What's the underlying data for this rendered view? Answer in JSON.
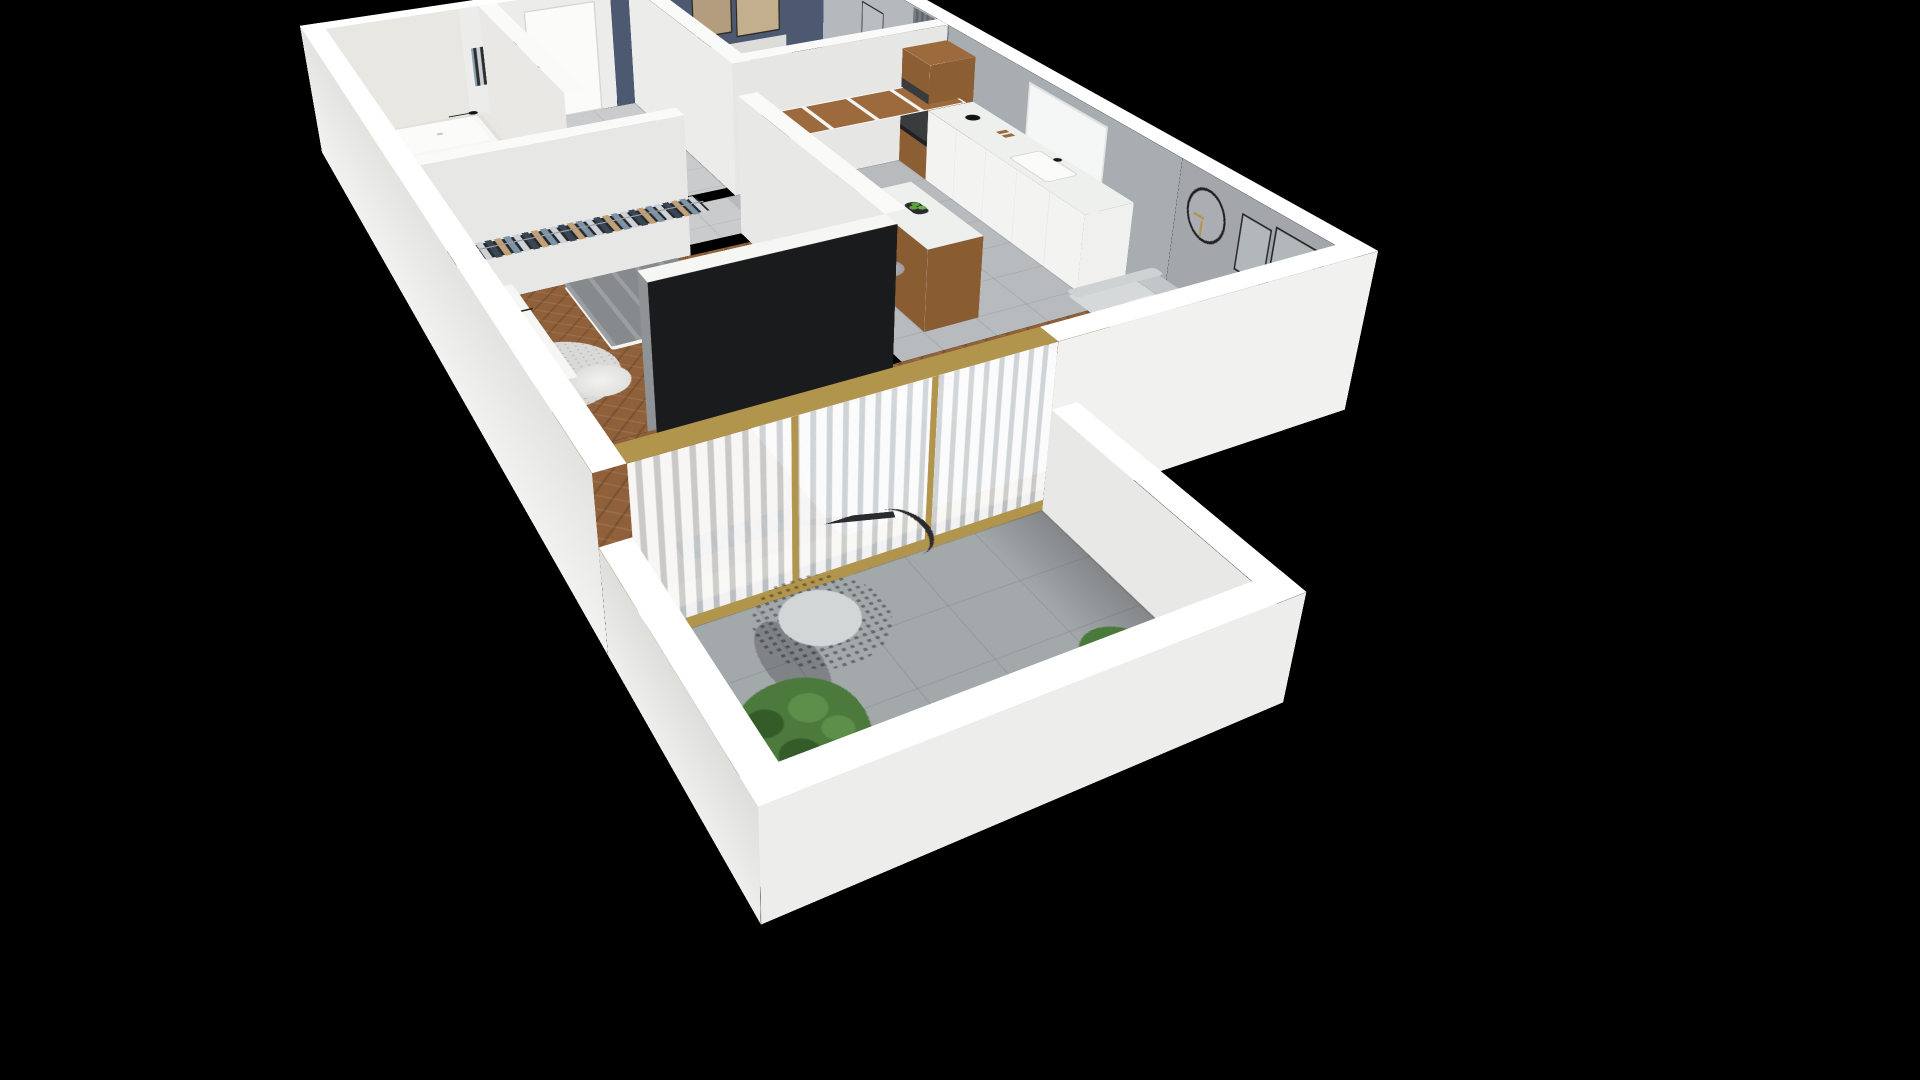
{
  "scene": {
    "type": "3d-isometric-floorplan-render",
    "background": "#000000",
    "apartment": {
      "rooms": [
        {
          "name": "bedroom-1",
          "floor": "wood-herringbone",
          "items": [
            "navy-accent-wall",
            "double-bed",
            "white-pillows",
            "gray-throw-blanket",
            "framed-artwork-pair",
            "side-wall-picture",
            "dark-curtain",
            "open-wood-wardrobe",
            "small-plant"
          ]
        },
        {
          "name": "entry-hall",
          "floor": "gray-tile",
          "items": [
            "entrance-door",
            "black-door-handle",
            "wall-coat-rack-with-hangers"
          ]
        },
        {
          "name": "bathroom",
          "floor": "gray-tile",
          "items": [
            "marble-surround",
            "bathtub",
            "black-shower-mixer"
          ]
        },
        {
          "name": "corridor",
          "floor": "gray-tile",
          "items": [
            "open-white-door"
          ]
        },
        {
          "name": "bedroom-2",
          "floor": "wood-herringbone",
          "items": [
            "bed",
            "gray-blanket",
            "open-clothes-rack",
            "hangers-with-clothes",
            "desk",
            "black-desk-lamp",
            "open-book",
            "fluffy-chair",
            "round-fluffy-rug"
          ]
        },
        {
          "name": "kitchen",
          "floor": "gray-tile",
          "items": [
            "window",
            "tall-wood-cabinet",
            "oven",
            "marble-countertop",
            "sink",
            "black-faucet",
            "kettle",
            "spice-jars",
            "kitchen-island",
            "bar-stools",
            "plate-of-green-apples"
          ]
        },
        {
          "name": "living-room",
          "floor": "wood-herringbone",
          "items": [
            "wall-clock",
            "gallery-of-five-frames",
            "sofa",
            "striped-cushion",
            "area-rug",
            "round-coffee-table",
            "flower-vase",
            "floor-lamp",
            "radiator",
            "gold-framed-glazing",
            "sheer-curtains",
            "gold-threshold"
          ]
        },
        {
          "name": "balcony",
          "floor": "large-gray-tiles",
          "items": [
            "white-parapet",
            "hanging-egg-chair",
            "chair-stand",
            "large-potted-plant",
            "small-potted-plant",
            "plant-stands"
          ]
        }
      ]
    },
    "colors": {
      "background": "#000000",
      "wall_top": "#ffffff",
      "wall_outer": "#f1f1ef",
      "wall_inner_white": "#ececea",
      "navy_accent_wall": "#4d5970",
      "gray_wall": "#a8adb1",
      "gray_wall_light": "#b5b9bd",
      "wood_floor": "#8f6039",
      "wood_cabinet": "#9c6a3c",
      "tile_floor": "#c9cbcc",
      "kitchen_tile": "#b8bbbd",
      "balcony_tile": "#a3a8aa",
      "marble": "#eef0ed",
      "sofa": "#d6d9da",
      "rug": "#cfd2d1",
      "blanket": "#868a8d",
      "black_detail": "#1a1b1c",
      "gold_frame": "#b2954c",
      "plant_green": "#4c7a3c",
      "rattan": "#8a6a40"
    }
  }
}
